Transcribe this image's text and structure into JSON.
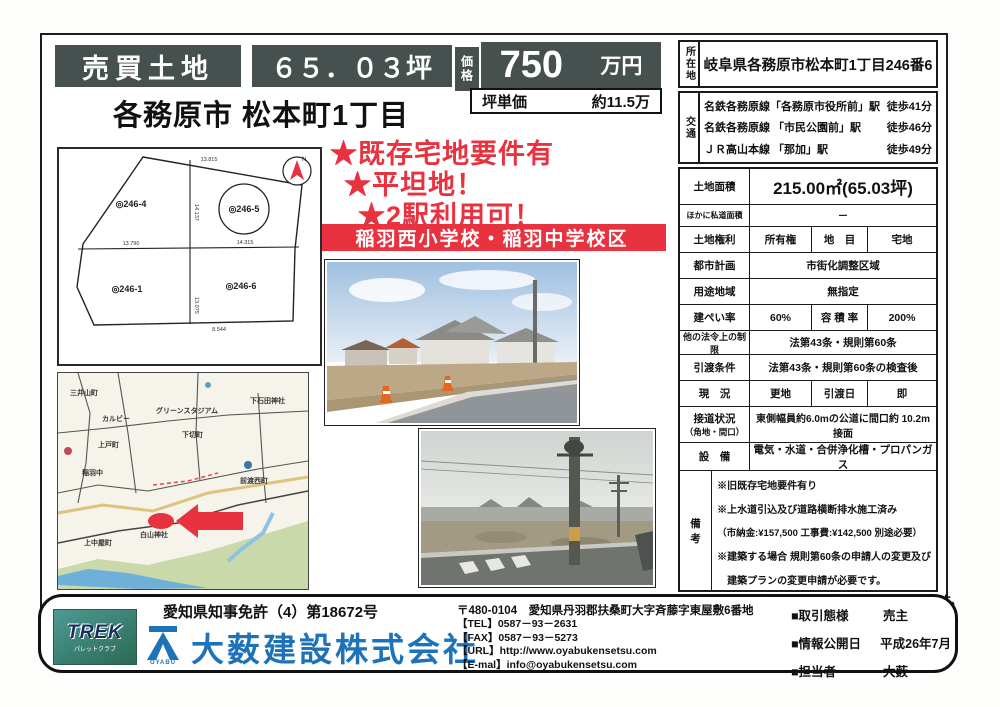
{
  "header": {
    "sale_type": "売買土地",
    "tsubo": "６５．０３坪",
    "price_label": "価格",
    "price_value": "750",
    "price_unit": "万円",
    "unit_price_label": "坪単価",
    "unit_price_value": "約11.5万",
    "town_title": "各務原市 松本町1丁目"
  },
  "highlights": {
    "star1": "★既存宅地要件有",
    "star2": "★平坦地！",
    "star3": "★2駅利用可！",
    "school_banner": "稲羽西小学校・稲羽中学校区"
  },
  "site_plan": {
    "parcel_tl": "◎246-4",
    "parcel_tr": "◎246-5",
    "parcel_bl": "◎246-1",
    "parcel_br": "◎246-6",
    "dim_top": "13.815",
    "dim_left_mid": "13.790",
    "dim_right_mid": "14.315",
    "dim_v_top": "14.137",
    "dim_v_bottom": "13.075",
    "dim_bottom": "8.544",
    "compass_n": "N"
  },
  "map": {
    "labels": [
      "三井山町",
      "カルビー",
      "グリーンスタジアム",
      "下切町",
      "上戸町",
      "稲羽中",
      "前渡西町",
      "白山神社",
      "上中屋町",
      "下石田神社"
    ]
  },
  "right_panel": {
    "location_label": "所在地",
    "location_value": "岐阜県各務原市松本町1丁目246番6",
    "access": [
      {
        "route": "名鉄各務原線「各務原市役所前」駅",
        "walk": "徒歩41分"
      },
      {
        "route": "名鉄各務原線 「市民公園前」駅",
        "walk": "徒歩46分"
      },
      {
        "route": "ＪＲ高山本線 「那加」駅",
        "walk": "徒歩49分"
      }
    ],
    "access_label": "交通",
    "land_area_label": "土地面積",
    "land_area_value": "215.00㎡(65.03坪)",
    "private_road_label": "ほかに私道面積",
    "private_road_value": "－",
    "land_right_label": "土地権利",
    "land_right_value": "所有権",
    "land_category_label": "地　目",
    "land_category_value": "宅地",
    "city_plan_label": "都市計画",
    "city_plan_value": "市街化調整区域",
    "zoning_label": "用途地域",
    "zoning_value": "無指定",
    "coverage_label": "建ぺい率",
    "coverage_value": "60%",
    "floor_ratio_label": "容 積 率",
    "floor_ratio_value": "200%",
    "other_law_label": "他の法令上の制限",
    "other_law_value": "法第43条・規則第60条",
    "handover_cond_label": "引渡条件",
    "handover_cond_value": "法第43条・規則第60条の検査後",
    "status_label": "現　況",
    "status_value": "更地",
    "handover_date_label": "引渡日",
    "handover_date_value": "即",
    "road_label1": "接道状況",
    "road_label2": "（角地・間口）",
    "road_value": "東側幅員約6.0mの公道に間口約 10.2m接面",
    "utility_label": "設　備",
    "utility_value": "電気・水道・合併浄化槽・プロパンガス",
    "remarks_label": "備　考",
    "remarks": [
      "※旧既存宅地要件有り",
      "※上水道引込及び道路横断排水施工済み",
      "（市納金:¥157,500 工事費:¥142,500 別途必要）",
      "※建築する場合 規則第60条の申請人の変更及び",
      "　建築プランの変更申請が必要です。"
    ],
    "bottom_note": "※図面と現状が相違する場合は現状優先とします。"
  },
  "footer": {
    "license": "愛知県知事免許（4）第18672号",
    "trek_logo": "TREK",
    "trek_sub": "パレットクラブ",
    "oyabu_logo": "OYABU",
    "company": "大薮建設株式会社",
    "postal": "〒480-0104　愛知県丹羽郡扶桑町大字斉藤字東屋敷6番地",
    "tel": "【TEL】0587－93－2631",
    "fax": "【FAX】0587－93－5273",
    "url": "【URL】http://www.oyabukensetsu.com",
    "email": "【E-mal】info@oyabukensetsu.com",
    "deal_label": "■取引態様",
    "deal_value": "売主",
    "publish_label": "■情報公開日",
    "publish_value": "平成26年7月",
    "staff_label": "■担当者",
    "staff_value": "大薮"
  },
  "colors": {
    "dark_box": "#46514f",
    "accent_red": "#e8323f",
    "brand_blue": "#1e72b8"
  }
}
